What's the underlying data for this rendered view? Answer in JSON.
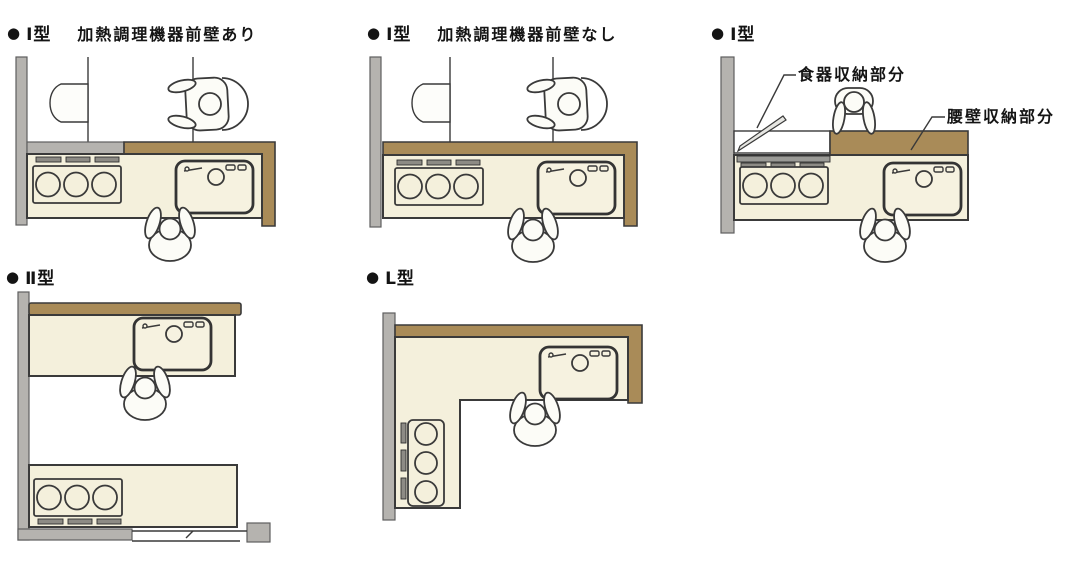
{
  "panels": [
    {
      "id": "i-front-wall",
      "bullet": "●",
      "type": "Ⅰ型",
      "subtitle": "加熱調理機器前壁あり"
    },
    {
      "id": "i-no-front-wall",
      "bullet": "●",
      "type": "Ⅰ型",
      "subtitle": "加熱調理機器前壁なし"
    },
    {
      "id": "i-annotated",
      "bullet": "●",
      "type": "Ⅰ型",
      "subtitle": "",
      "annotations": {
        "dish": "食器収納部分",
        "waist": "腰壁収納部分"
      }
    },
    {
      "id": "ii-type",
      "bullet": "●",
      "type": "Ⅱ型",
      "subtitle": ""
    },
    {
      "id": "l-type",
      "bullet": "●",
      "type": "L型",
      "subtitle": ""
    }
  ],
  "colors": {
    "wall_gray": "#b5b3af",
    "wood_brown": "#a98b58",
    "counter_cream": "#f4f0dc",
    "sink_cream": "#f6f2e0",
    "vent_gray": "#8d8b85",
    "figure_white": "#fcfcf7",
    "outline": "#3a3a3a"
  }
}
